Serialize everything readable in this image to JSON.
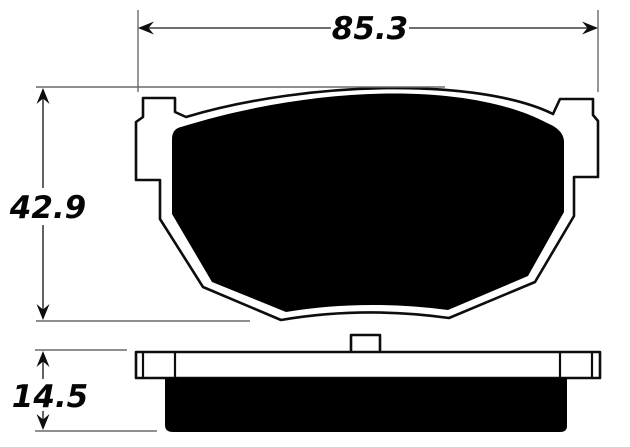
{
  "diagram": {
    "kind": "technical-drawing",
    "subject": "brake-pad-dimension-diagram",
    "background_color": "#ffffff",
    "outline_color": "#0d0d0d",
    "dimension_line_color": "#3d3d3d",
    "fill_color": "#000000",
    "dimensions": {
      "width": {
        "label": "85.3",
        "orientation": "horizontal",
        "location": "top"
      },
      "height": {
        "label": "42.9",
        "orientation": "vertical",
        "location": "left"
      },
      "thickness": {
        "label": "14.5",
        "orientation": "vertical",
        "location": "bottom-left"
      }
    }
  }
}
